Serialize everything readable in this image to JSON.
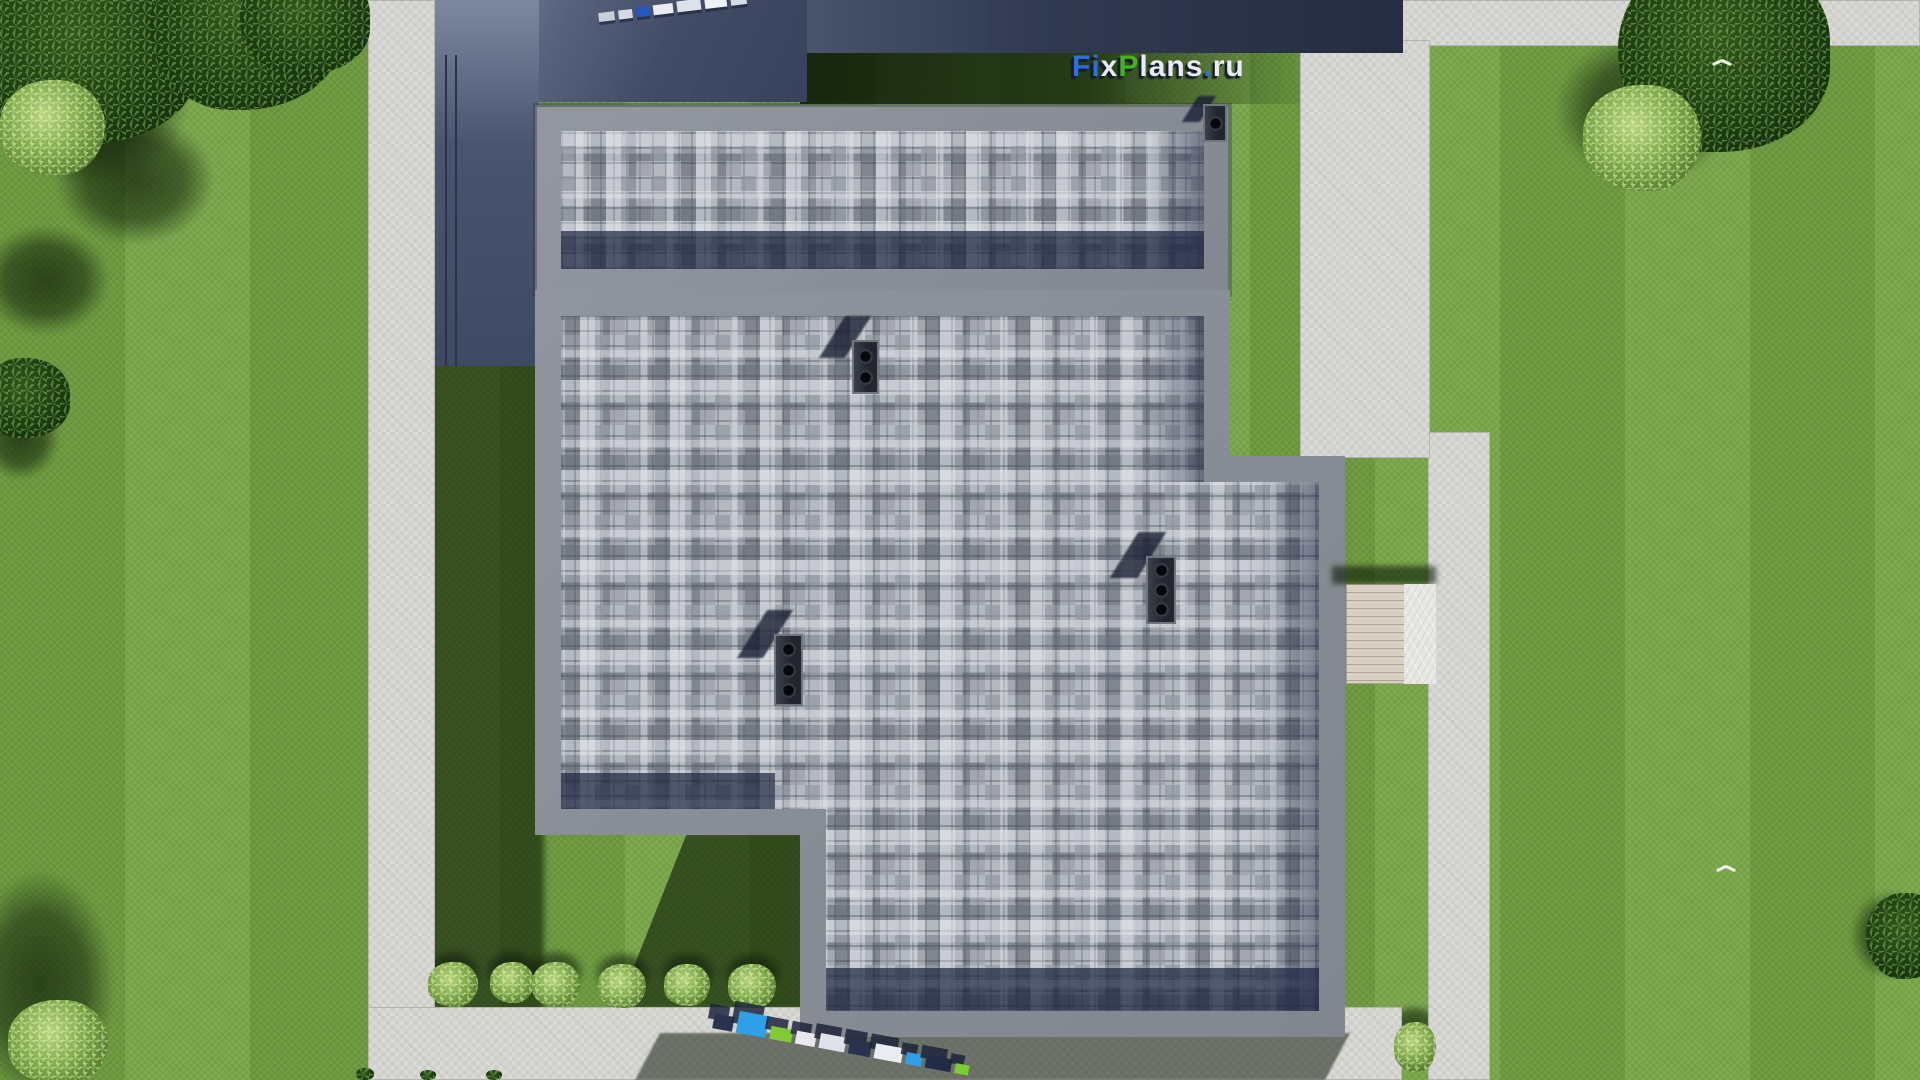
{
  "meta": {
    "description": "Aerial top-down 3D architectural render of a flat-roof house with paver roof tiles, lawn, concrete walkways, trees and bushes",
    "source_visible_text_only": true
  },
  "brand": {
    "name": "FixPlans.ru",
    "segments": [
      {
        "text": "F",
        "color": "#2e6fe0"
      },
      {
        "text": "i",
        "color": "#2e6fe0"
      },
      {
        "text": "x",
        "color": "#e9ebf2"
      },
      {
        "text": "P",
        "color": "#43b21e"
      },
      {
        "text": "lans",
        "color": "#e9ebf2"
      },
      {
        "text": ".",
        "color": "#2e6fe0"
      },
      {
        "text": "ru",
        "color": "#e9ebf2"
      }
    ]
  },
  "watermarks": {
    "top_edge": "FixPlans.ru (tiny 3D watermark, cut off at top edge)",
    "bottom_path": "FixPlans.ru (tiny 3D watermark lying on walkway)"
  },
  "scene": {
    "building": {
      "sections": [
        "upper garage roof",
        "main roof with bottom-left notch"
      ],
      "roof_finish": "gray square paver mosaic",
      "parapet_color": "#8a8e96",
      "paver_color": "#b4b8c0",
      "shadow_band_color": "#2e374f",
      "chimney_vents": 4,
      "stone_terrace_color": "#49536e",
      "wood_walkway_color": "#d8d0c2"
    },
    "landscape": {
      "lawn_color": "#74a243",
      "lawn_shadow_color": "#16270d",
      "walkway_color": "#d7d7d3",
      "trees_dark": 6,
      "bushes_light": 9,
      "white_birds": 2
    }
  }
}
